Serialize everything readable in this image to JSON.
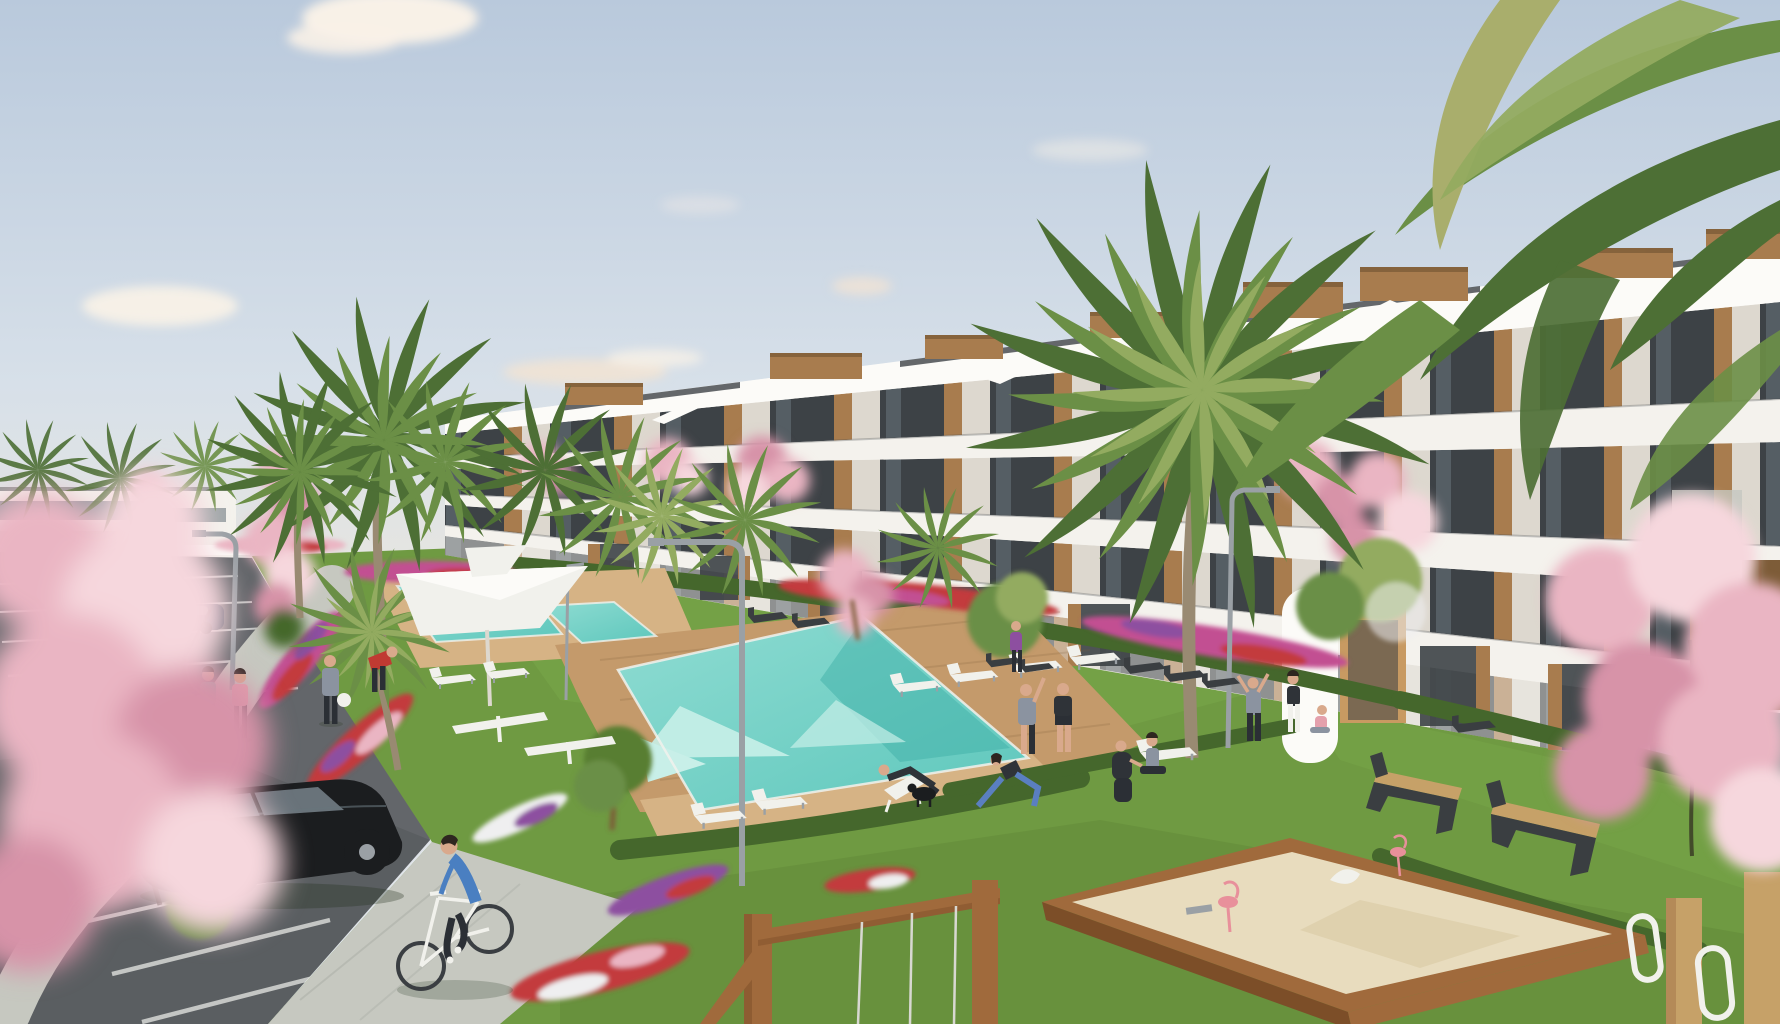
{
  "meta": {
    "title": "Residential resort complex – exterior architectural rendering",
    "width": 1780,
    "height": 1024
  },
  "scene": {
    "description": "Sunny 3D rendering of a modern terraced white apartment complex with wooden accents, palm trees, pink blossom trees, turquoise swimming pools with wooden decks, lawns with flower beds and hedges, a parking lot with cars, a cyclist, people exercising and relaxing, benches, parasols, a wooden sandbox with flamingo spring riders and a wooden swing frame.",
    "objects": {
      "buildings": [
        "terraced white apartment block with wood-clad rooftop boxes",
        "distant low white building behind parking"
      ],
      "vegetation": [
        "palm trees",
        "pink cherry-blossom trees",
        "green trees",
        "hedges",
        "mixed flower beds",
        "lawns"
      ],
      "water": [
        "large turquoise pool",
        "upper lap pool",
        "small square pool"
      ],
      "amenities": [
        "wooden pool deck",
        "white sun loungers",
        "white parasols",
        "dark angular benches",
        "wood-slat benches",
        "curved street lamps",
        "outdoor fitness equipment",
        "wooden sandbox with pink flamingo riders",
        "wooden swing frame",
        "timber play frame"
      ],
      "vehicles": [
        "black hatchback",
        "dark blue sedan",
        "three parked dark cars",
        "gray parked car",
        "white bicycle"
      ],
      "people": [
        "cyclist in blue",
        "two women walking",
        "man with ball",
        "man in red tending flowers",
        "man with raised arm",
        "man in dark sportswear",
        "woman lunging in blue leggings",
        "crouching photographer",
        "seated woman",
        "man on deck chair",
        "trio by the path",
        "child sitting",
        "black dog"
      ]
    }
  },
  "palette": {
    "sky_top": "#b9c9dc",
    "sky_mid": "#d7e0e9",
    "sky_low": "#eae7df",
    "cloud": "#f8f1e7",
    "cloud_warm": "#f1e3d4",
    "white_wall": "#f4f2ed",
    "wall_bright": "#fcfbf8",
    "wall_shade": "#ddd8cf",
    "wall_warm": "#c89a62",
    "glass_dark": "#3d4246",
    "glass_mid": "#68747c",
    "roof_edge": "#4b5054",
    "wood": "#a87c4e",
    "wood_dark": "#7d5c38",
    "wood_light": "#c6a168",
    "palm_dark": "#4d6f35",
    "palm_mid": "#6b8f46",
    "palm_light": "#93ab60",
    "palm_yellow": "#a9ae6c",
    "trunk": "#998a72",
    "grass": "#6f9a42",
    "grass_light": "#7fae4d",
    "grass_dark": "#587e31",
    "hedge": "#45672c",
    "pool": "#5ec7bc",
    "pool_deep": "#3fb0a8",
    "pool_light": "#8fdcd2",
    "pool_pale": "#c8efe8",
    "deck": "#c49a6b",
    "deck_light": "#d6b385",
    "path": "#c6c8c0",
    "path_dark": "#aaada6",
    "asphalt": "#63666a",
    "asphalt_dark": "#55585b",
    "line_white": "#e8e9e6",
    "sand": "#e8dcbe",
    "sand_shade": "#d9c9a4",
    "frame_wood": "#a06a3c",
    "frame_dark": "#7c4e28",
    "blossom": "#eab5c3",
    "blossom_light": "#f6d7dd",
    "blossom_deep": "#d793a8",
    "flower_red": "#c33b3e",
    "flower_magenta": "#c24f92",
    "flower_purple": "#8d4fa0",
    "flower_white": "#efeff0",
    "flamingo": "#e8909b",
    "car_black": "#1b1d1f",
    "car_dark": "#3a3e42",
    "car_blue": "#2f3c4e",
    "car_glass": "#77838b",
    "metal": "#9aa0a5",
    "skin": "#d9a98c",
    "hair_dark": "#2e2620",
    "shirt_teal": "#57b8a8",
    "shirt_pink": "#e4a0ac",
    "shirt_blue": "#4a7fc1",
    "shirt_red": "#c03a32",
    "shirt_gray": "#8b93a0",
    "shirt_dark": "#2f3338",
    "pants_dark": "#2b2f35",
    "legging_blue": "#5a7fc0",
    "bench_dark": "#3a3e41",
    "white_furn": "#f1f1ec",
    "shadow": "#22301a"
  }
}
